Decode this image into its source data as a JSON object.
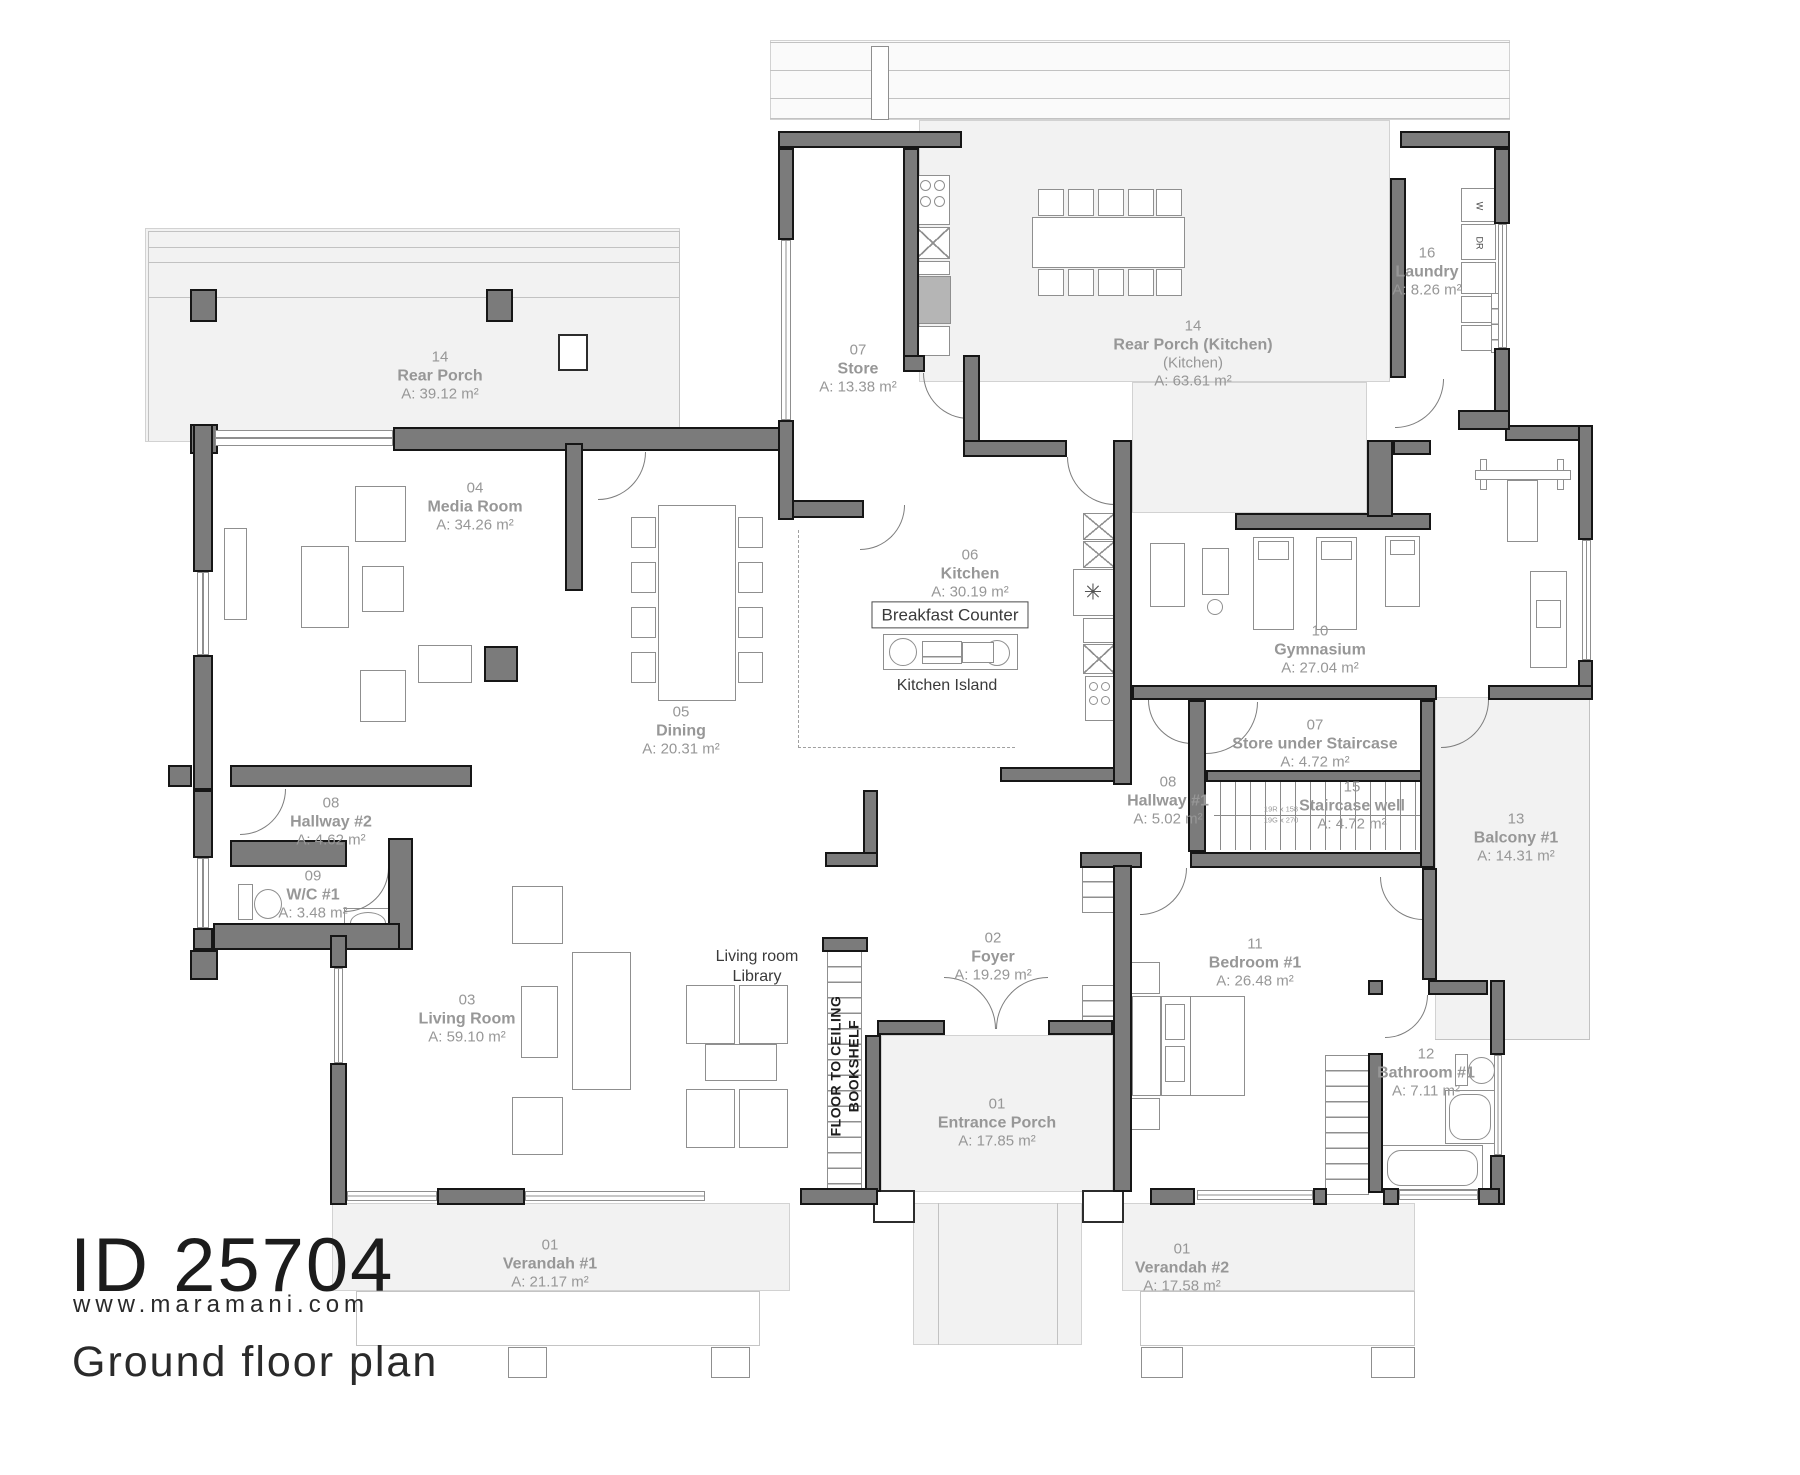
{
  "branding": {
    "id": "ID 25704",
    "website": "www.maramani.com",
    "plan_title": "Ground floor plan"
  },
  "rooms": [
    {
      "number": "14",
      "name": "Rear Porch",
      "area": "A: 39.12 m²",
      "x": 440,
      "y": 376
    },
    {
      "number": "04",
      "name": "Media Room",
      "area": "A: 34.26 m²",
      "x": 475,
      "y": 507
    },
    {
      "number": "07",
      "name": "Store",
      "area": "A: 13.38 m²",
      "x": 858,
      "y": 369
    },
    {
      "number": "14",
      "name": "Rear Porch (Kitchen)",
      "sub": "(Kitchen)",
      "area": "A: 63.61 m²",
      "x": 1193,
      "y": 354
    },
    {
      "number": "16",
      "name": "Laundry",
      "area": "A: 8.26 m²",
      "x": 1427,
      "y": 272
    },
    {
      "number": "06",
      "name": "Kitchen",
      "area": "A: 30.19 m²",
      "x": 970,
      "y": 574
    },
    {
      "number": "10",
      "name": "Gymnasium",
      "area": "A: 27.04 m²",
      "x": 1320,
      "y": 650
    },
    {
      "number": "05",
      "name": "Dining",
      "area": "A: 20.31 m²",
      "x": 681,
      "y": 731
    },
    {
      "number": "07",
      "name": "Store under Staircase",
      "area": "A: 4.72 m²",
      "x": 1315,
      "y": 744
    },
    {
      "number": "08",
      "name": "Hallway #1",
      "area": "A: 5.02 m²",
      "x": 1168,
      "y": 801
    },
    {
      "number": "15",
      "name": "Staircase well",
      "area": "A: 4.72 m²",
      "x": 1352,
      "y": 806
    },
    {
      "number": "13",
      "name": "Balcony #1",
      "area": "A: 14.31 m²",
      "x": 1516,
      "y": 838
    },
    {
      "number": "08",
      "name": "Hallway #2",
      "area": "A: 4.62 m²",
      "x": 331,
      "y": 822
    },
    {
      "number": "09",
      "name": "W/C #1",
      "area": "A: 3.48 m²",
      "x": 313,
      "y": 895
    },
    {
      "number": "03",
      "name": "Living Room",
      "area": "A: 59.10 m²",
      "x": 467,
      "y": 1019
    },
    {
      "number": "02",
      "name": "Foyer",
      "area": "A: 19.29 m²",
      "x": 993,
      "y": 957
    },
    {
      "number": "11",
      "name": "Bedroom #1",
      "area": "A: 26.48 m²",
      "x": 1255,
      "y": 963
    },
    {
      "number": "12",
      "name": "Bathroom #1",
      "area": "A: 7.11 m²",
      "x": 1426,
      "y": 1073
    },
    {
      "number": "01",
      "name": "Entrance Porch",
      "area": "A: 17.85 m²",
      "x": 997,
      "y": 1123
    },
    {
      "number": "01",
      "name": "Verandah #1",
      "area": "A: 21.17 m²",
      "x": 550,
      "y": 1264
    },
    {
      "number": "01",
      "name": "Verandah #2",
      "area": "A: 17.58 m²",
      "x": 1182,
      "y": 1268
    }
  ],
  "annotations": [
    {
      "text": "Breakfast Counter",
      "x": 950,
      "y": 615,
      "style": "boxed"
    },
    {
      "text": "Kitchen Island",
      "x": 947,
      "y": 686,
      "style": "plain"
    },
    {
      "text": "Living room\nLibrary",
      "x": 757,
      "y": 967,
      "style": "plain"
    },
    {
      "text": "FLOOR TO CEILING\nBOOKSHELF",
      "x": 845,
      "y": 1066,
      "style": "rotated"
    },
    {
      "text": "W",
      "x": 1479,
      "y": 206,
      "style": "rotsmall"
    },
    {
      "text": "DR",
      "x": 1479,
      "y": 243,
      "style": "rotsmall"
    },
    {
      "text": "19R x 158",
      "x": 1281,
      "y": 809,
      "style": "tiny"
    },
    {
      "text": "19G x 270",
      "x": 1281,
      "y": 820,
      "style": "tiny"
    },
    {
      "text": "✳",
      "x": 1093,
      "y": 592,
      "style": "star"
    }
  ]
}
